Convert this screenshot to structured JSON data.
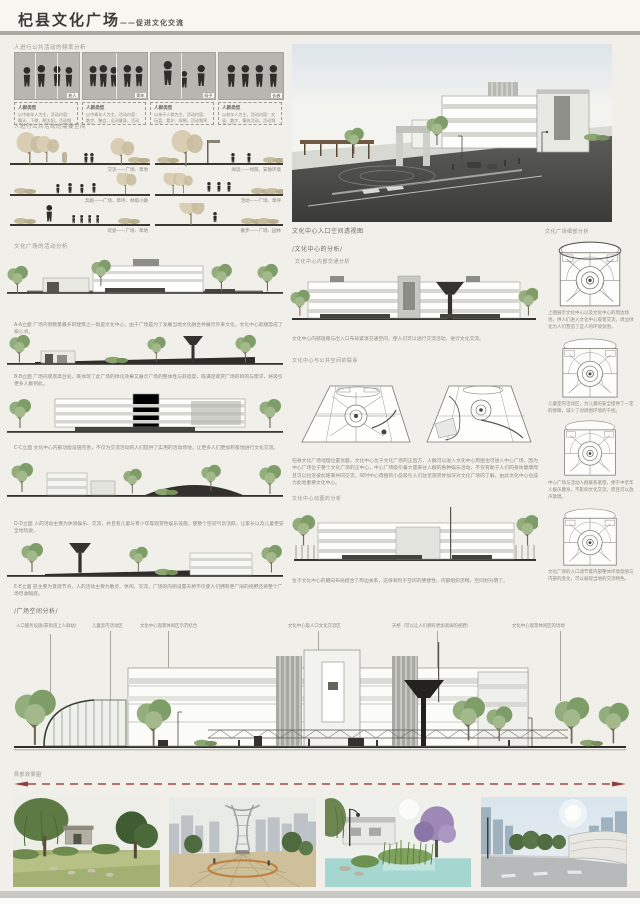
{
  "header": {
    "title": "杞县文化广场",
    "subtitle": "——促进文化交流"
  },
  "section_frequency": {
    "label": "人进行公共活动的频率分析",
    "panels": [
      {
        "tag": "老人",
        "caption_title": "人群类型",
        "caption": "以中老年人为主，活动内容：聊天、下棋、晒太阳，活动频率较高。"
      },
      {
        "tag": "青年",
        "caption_title": "人群类型",
        "caption": "以中青年人为主，活动内容：散步、聚会、运动健身，活动频率一般。"
      },
      {
        "tag": "母子",
        "caption_title": "人群类型",
        "caption": "以亲子人群为主，活动内容：玩耍、看护、休憩，活动频率较高。"
      },
      {
        "tag": "长者",
        "caption_title": "人群类型",
        "caption": "以老年人为主，活动内容：交谈、散步、集体活动，活动频率较高。"
      }
    ]
  },
  "section_space": {
    "label": "人进行公共活动的需要空间",
    "sketches": [
      {
        "caption": "交流——广场、草地"
      },
      {
        "caption": "阅读——绿荫、安静环境"
      },
      {
        "caption": "奔跑——广场、草坪、林荫小路"
      },
      {
        "caption": "活动——广场、草坪"
      },
      {
        "caption": "玩耍——广场、草地"
      },
      {
        "caption": "散步——广场、园林"
      }
    ]
  },
  "perspective": {
    "caption": "文化中心入口空间透视图"
  },
  "detail_column": {
    "label": "文化广场细部分析",
    "diagrams": [
      {
        "caption": "上图展示文化中心以及文化中心的周边场地，供人们进入文化中心观景交流，周边绿化为人们营造了宜人的环境氛围。"
      },
      {
        "caption": "儿童室内活动区，为儿童的安全提供了一定的保障，减少了对周围环境的干扰。"
      },
      {
        "caption": "中心广场与活动人群联系紧密，便于中老年人娱乐健身，不影响文化交流，而且可以放声歌唱。"
      },
      {
        "caption": "文化广场的入口调节着内部整体环境氛围与内部的变化，可以展现当地的交流特色。"
      }
    ]
  },
  "activity_column": {
    "label": "文化广场的活动分析",
    "elevations": [
      {
        "caption": "A-A立面  广场内侧数量最多的建筑之一就是文化中心，由于广场是为了发展当地文化融合并展示外来文化，文化中心就顺势成了核心点。"
      },
      {
        "caption": "B-B立面  广场内观景高台处，既体现了此广场的绿化效果又展示广场的整体性与舒适度，既满足观赏广场的目的与需求，将吸引更多人群到此。"
      },
      {
        "caption": "C-C立面  文化中心内部功能设施完善，不仅为交流活动的人们提供了实用的活动场地，让更多人们更加积极地进行文化交流。"
      },
      {
        "caption": "D-D立面  人的活动主要为休闲娱乐、交流，并且有儿童与青少年等观赏性娱乐设施，使整个空间气氛活跃，让家长以及儿童更安全地玩耍。"
      },
      {
        "caption": "E-E立面  前主要为景观节点，人的活动主要为散步、休闲、交流，广场的内侧设置天桥不仅使人们拥有更广阔的视野还将整个广场尽收眼底。"
      }
    ]
  },
  "center_column": {
    "header": "/文化中心的分析/",
    "traffic_label": "文化中心内部交通分析",
    "traffic_caption": "文化中心内部道路与出入口布局紧凑交通空间，使人们可以进行交流活动，进行文化交流。",
    "connection_label": "文化中心与公共空间的联系",
    "connection_paragraph": "杞县文化广场地理位置优越，文化中心位于文化广场的正后方，人群可以进入文化中心周围也可进入中心广场，因为中心广场位于整个文化广场的正中心，中心广场吸引着大量来往人群的各种娱乐活动，不仅有助于人们的身体健康而且可以拉近彼此距离共同交流，同时中心周围的小品吸引人们驻足观赏并加深对文化广场的了解，由此文化中心也成为此地重要文化中心。",
    "layout_label": "文化中心动图的分析",
    "layout_caption": "位于文化中心的朝向布局结合了周边关系，这样有利于空间的便捷性，内部组织流畅，空间划分明了。"
  },
  "plaza_section": {
    "header": "/广场空间分析/",
    "callouts": [
      "入口服务设施(靠街道上人群站)",
      "儿童室内活动区",
      "文化中心观景休闲区示范结合",
      "文化中心吸人口文化交流区",
      "天桥（可以让人们拥有更加宽阔的视野）",
      "文化中心观景休闲区的场地"
    ]
  },
  "bottom": {
    "label": "局部效果图"
  },
  "colors": {
    "accent_red": "#a04a48",
    "bar_gray": "#a9a9a2",
    "paper": "#f0efe9"
  }
}
